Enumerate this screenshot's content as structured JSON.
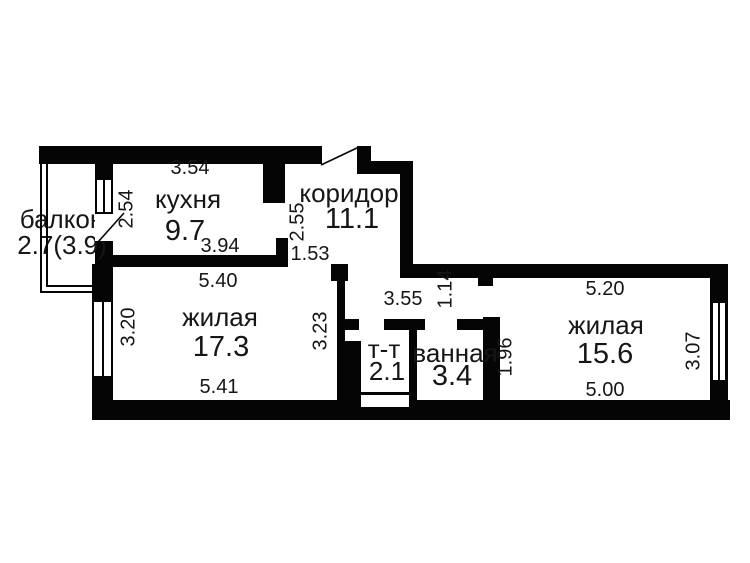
{
  "plan_title": "apartment-floor-plan",
  "rooms": {
    "balcony": {
      "name": "балкон",
      "area": "2.7(3.9)"
    },
    "kitchen": {
      "name": "кухня",
      "area": "9.7"
    },
    "corridor": {
      "name": "коридор",
      "area": "11.1"
    },
    "living1": {
      "name": "жилая",
      "area": "17.3"
    },
    "toilet": {
      "name": "т-т",
      "area": "2.1"
    },
    "bathroom": {
      "name": "ванная",
      "area": "3.4"
    },
    "living2": {
      "name": "жилая",
      "area": "15.6"
    }
  },
  "dimensions": {
    "kitchen_top": "3.54",
    "kitchen_left_wall": "2.54",
    "kitchen_bottom": "3.94",
    "living1_top": "5.40",
    "living1_left": "3.20",
    "living1_right": "3.23",
    "living1_bottom": "5.41",
    "corridor_height": "2.55",
    "corridor_opening": "1.53",
    "corridor_bottom": "3.55",
    "passage_height": "1.14",
    "bathroom_right_wall": "1.96",
    "living2_top": "5.20",
    "living2_bottom": "5.00",
    "living2_right": "3.07"
  },
  "colors": {
    "wall": "#050505",
    "text": "#161616",
    "background": "#ffffff"
  }
}
